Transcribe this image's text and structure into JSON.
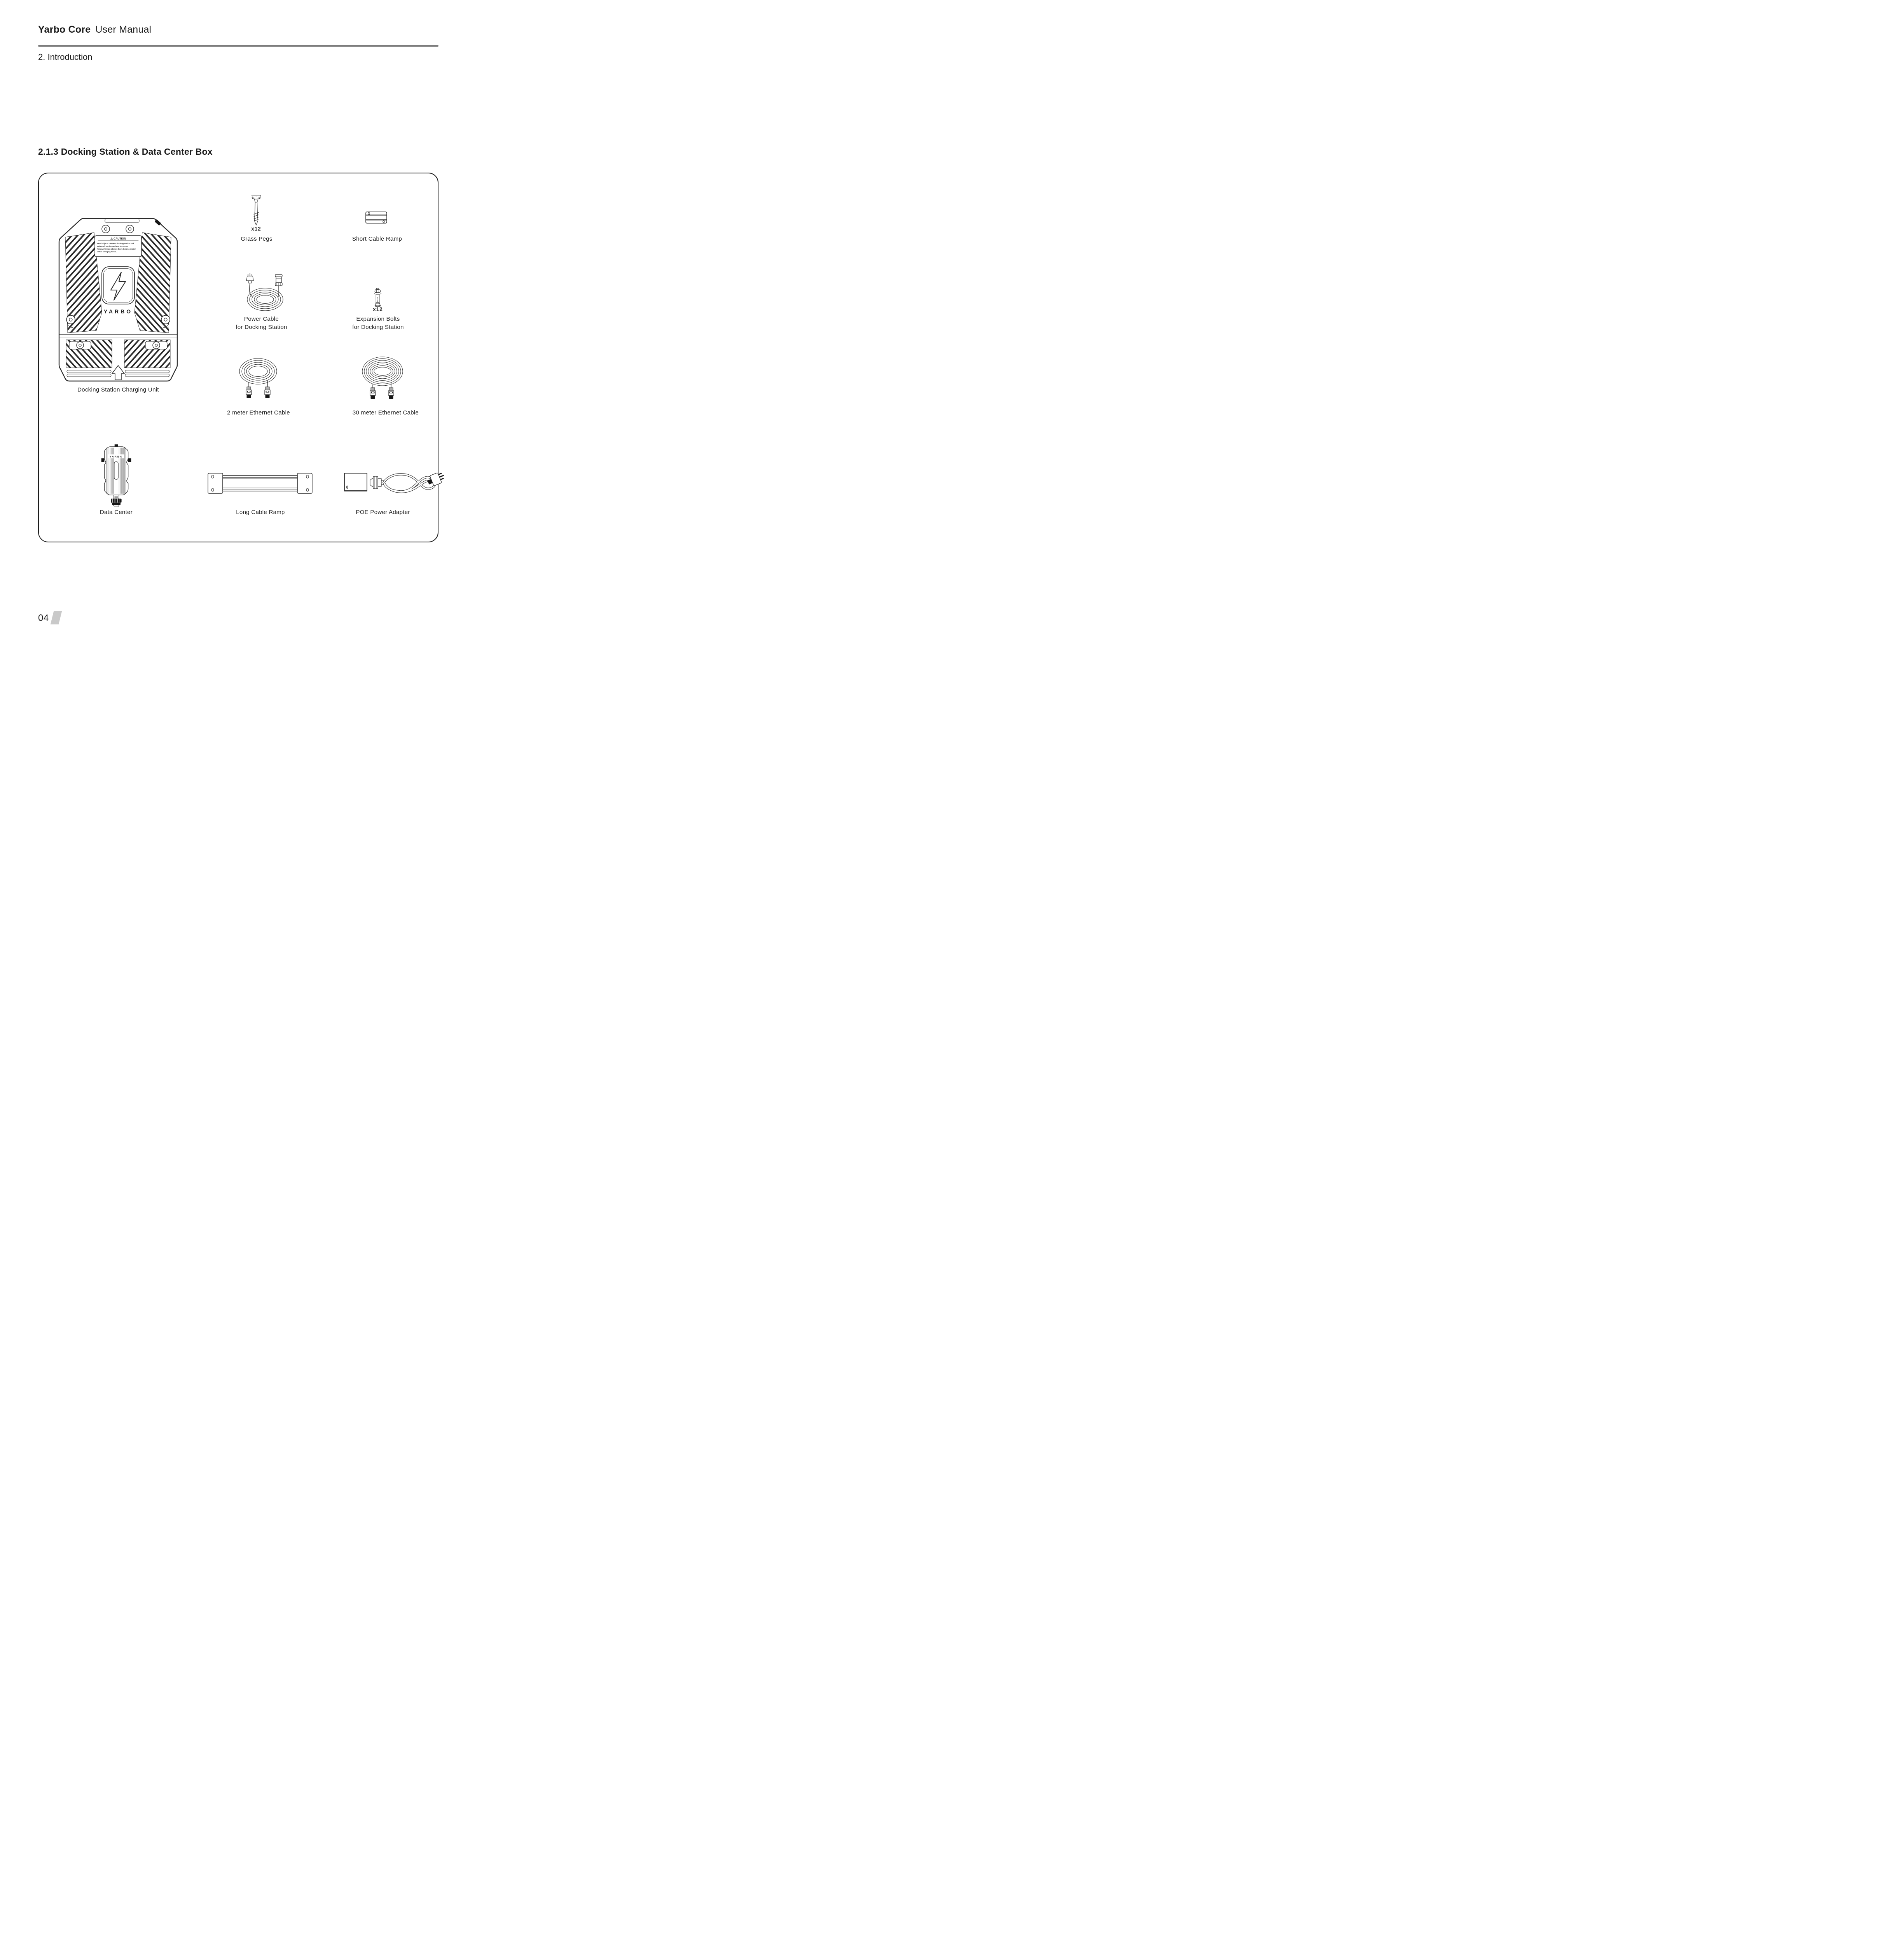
{
  "header": {
    "product": "Yarbo Core",
    "manual": "User Manual",
    "chapter": "2. Introduction"
  },
  "section": {
    "title": "2.1.3 Docking Station & Data Center Box"
  },
  "kit": {
    "docking_station": {
      "label": "Docking Station Charging Unit"
    },
    "grass_pegs": {
      "qty": "x12",
      "label": "Grass Pegs"
    },
    "short_cable_ramp": {
      "label": "Short Cable Ramp"
    },
    "power_cable": {
      "line1": "Power Cable",
      "line2": "for Docking Station"
    },
    "expansion_bolts": {
      "qty": "x12",
      "line1": "Expansion Bolts",
      "line2": "for Docking Station"
    },
    "ethernet_2m": {
      "label": "2 meter Ethernet Cable"
    },
    "ethernet_30m": {
      "label": "30 meter Ethernet Cable"
    },
    "data_center": {
      "label": "Data Center"
    },
    "long_cable_ramp": {
      "label": "Long Cable Ramp"
    },
    "poe_adapter": {
      "label": "POE Power Adapter"
    }
  },
  "docking_art": {
    "caution_title": "⚠ CAUTION",
    "caution_lines": [
      "Metal objects between docking station and",
      "Yarbo will get hot and can burn you.",
      "Remove foreign objects from docking station",
      "before charging Yarbo."
    ],
    "logo": "YARBO"
  },
  "data_center_art": {
    "logo": "YARBO"
  },
  "footer": {
    "page": "04"
  },
  "colors": {
    "text": "#1b1b1b",
    "rule_gray": "#7d7d7d",
    "box_border": "#1c1c1c",
    "slab_gray": "#c9c9c9",
    "line_art": "#2b2b2b"
  }
}
